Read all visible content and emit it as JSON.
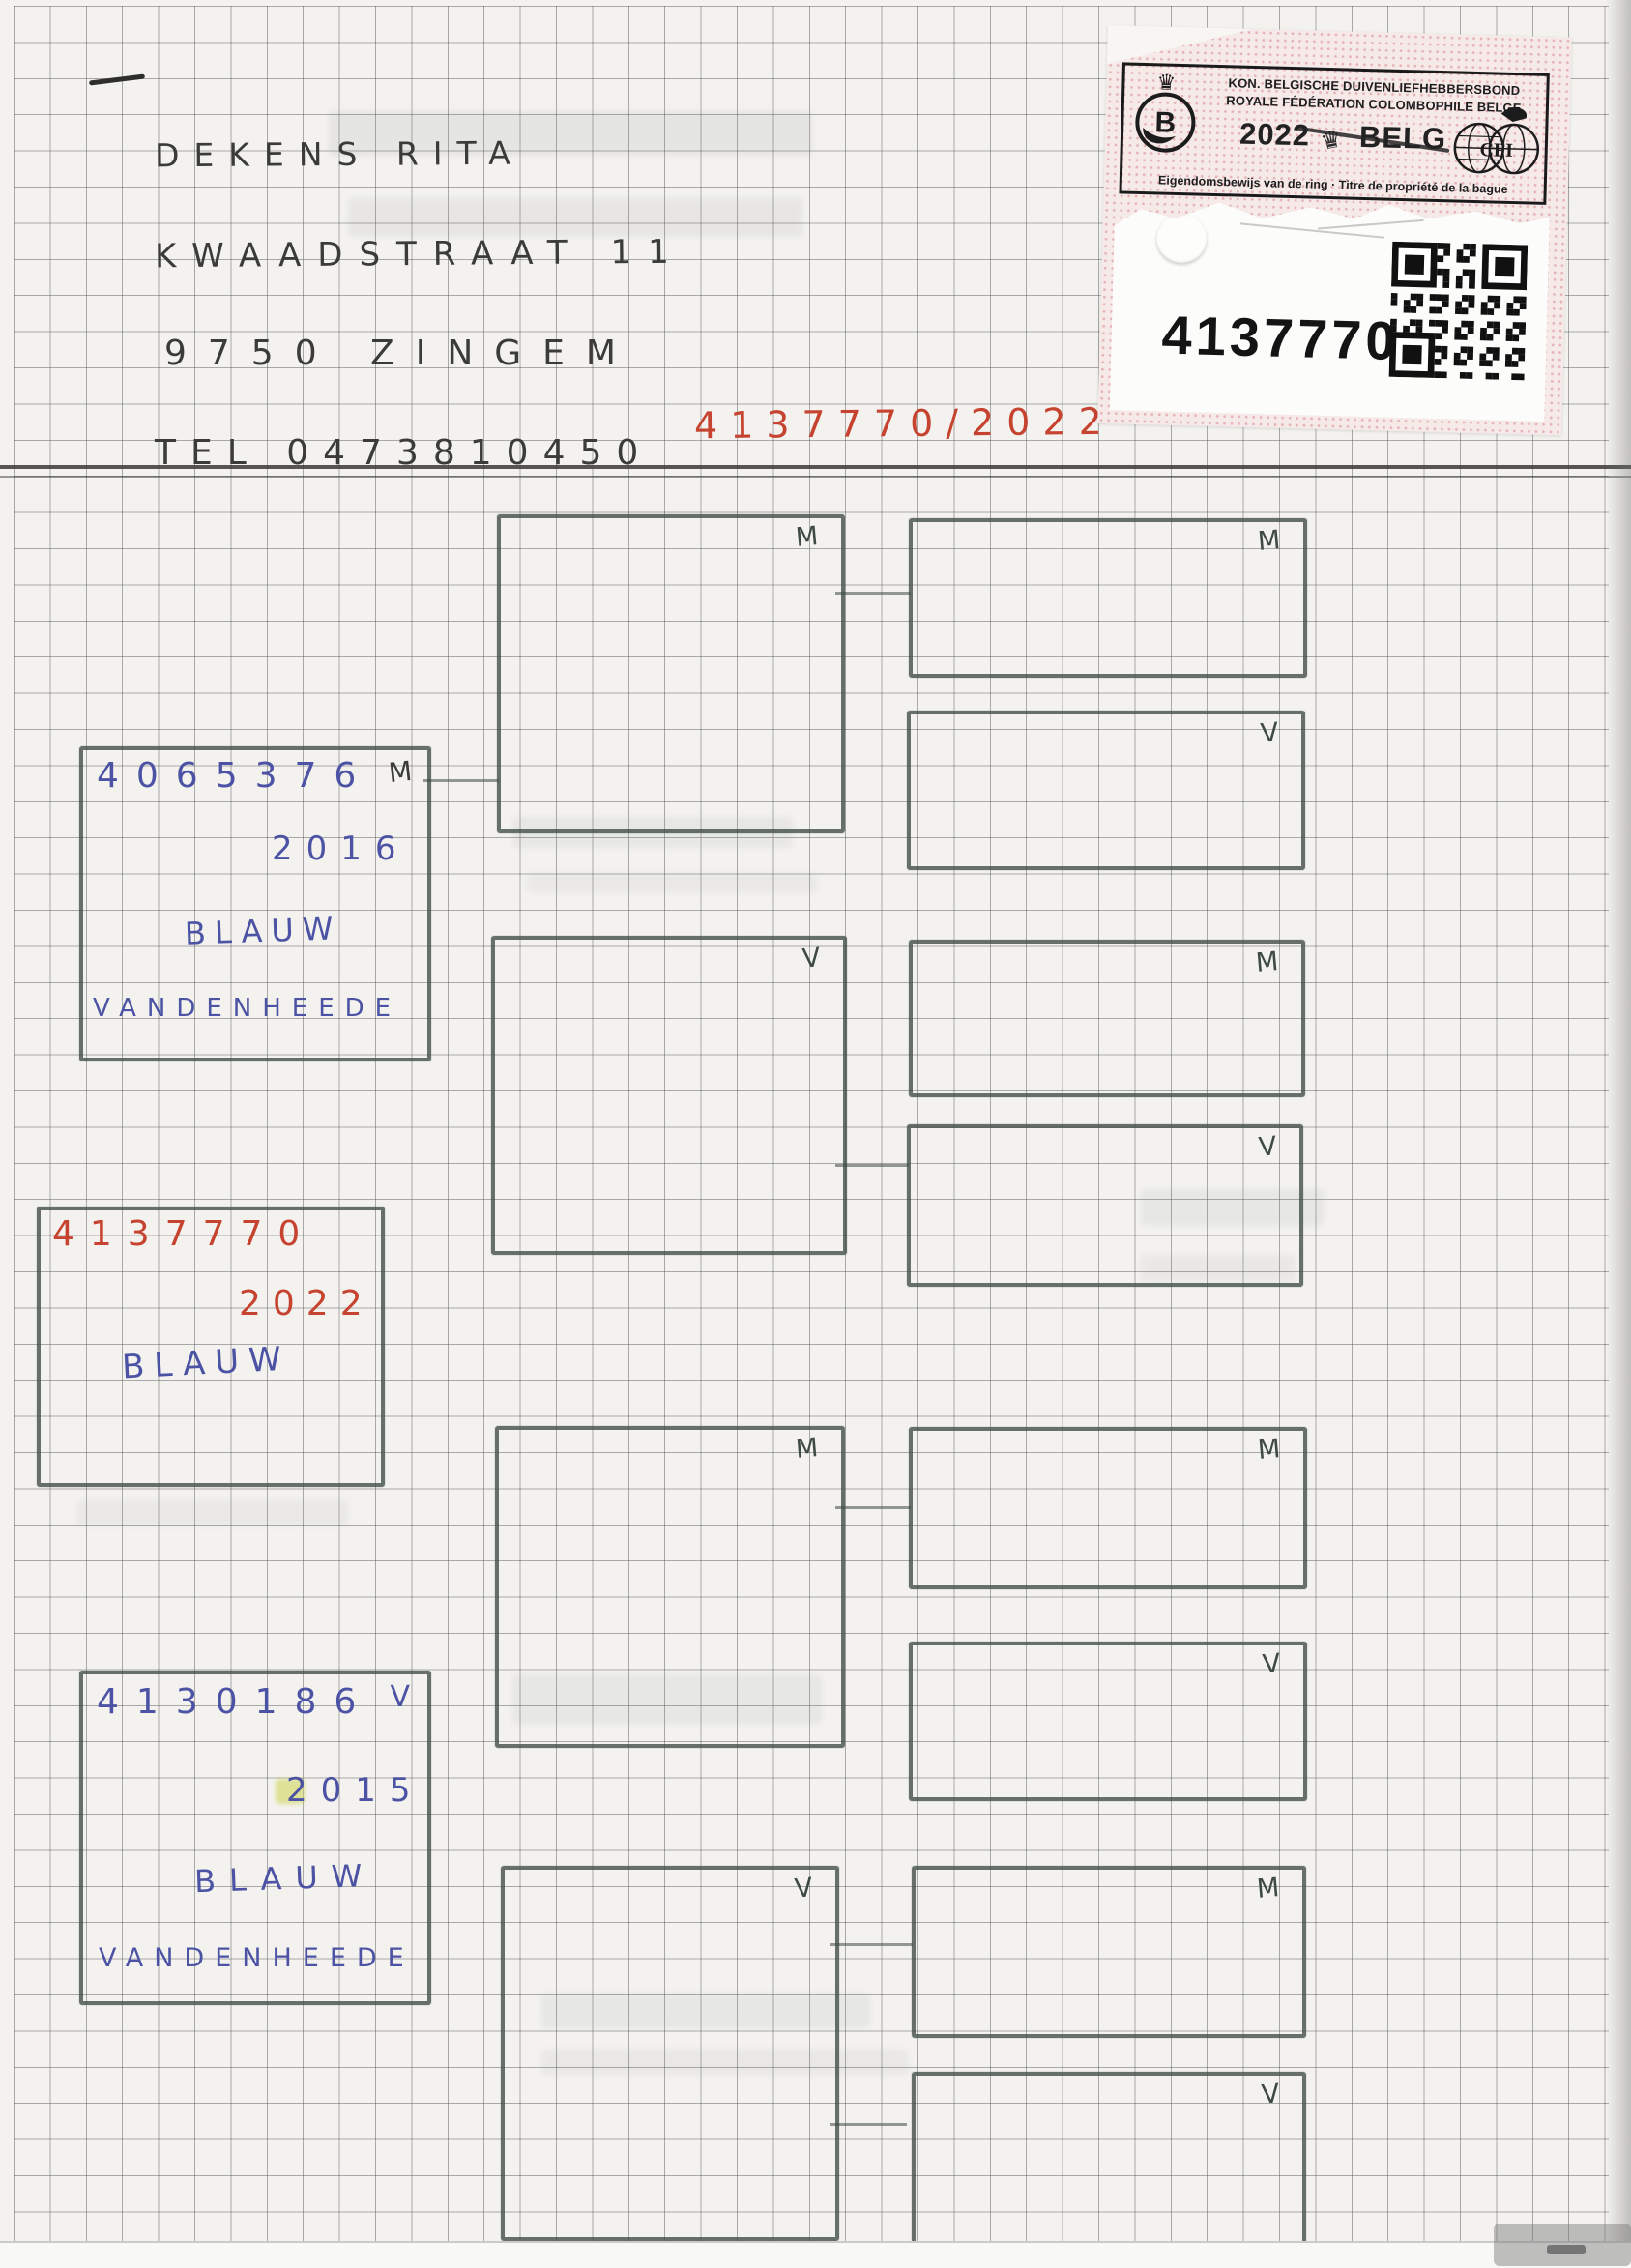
{
  "page": {
    "kind": "Scanned handwritten pigeon pedigree sheet on graph paper"
  },
  "owner": {
    "name": "DEKENS RITA",
    "street": "KWAADSTRAAT 11",
    "city": "9750 ZINGEM",
    "phone": "TEL 0473810450",
    "ring_note": "4137770/2022"
  },
  "sticker": {
    "federation_nl": "KON. BELGISCHE DUIVENLIEFHEBBERSBOND",
    "federation_fr": "ROYALE FÉDÉRATION COLOMBOPHILE BELGE",
    "year": "2022",
    "country": "BELG",
    "title": "Eigendomsbewijs van de ring · Titre de propriété de la bague",
    "ring_number": "4137770",
    "logo_left_letter": "B",
    "logo_right_letters": "CFI",
    "crown_icon": "♛"
  },
  "pedigree": {
    "subject": {
      "ring": "4137770",
      "year": "2022",
      "color": "BLAUW"
    },
    "sire": {
      "ring": "4065376",
      "sex": "M",
      "year": "2016",
      "color": "BLAUW",
      "breeder": "VANDENHEEDE"
    },
    "dam": {
      "ring": "4130186",
      "sex": "V",
      "year": "2015",
      "color": "BLAUW",
      "breeder": "VANDENHEEDE"
    },
    "gen2_labels": [
      "M",
      "V",
      "M",
      "V"
    ],
    "gen3_labels": [
      "M",
      "V",
      "M",
      "V",
      "M",
      "V",
      "M",
      "V"
    ]
  },
  "colors": {
    "red_ink": "#c6432f",
    "blue_ink": "#4d53a4",
    "pencil": "#3b3b39",
    "box_line": "#46584c",
    "sticker_dot_pink": "#e6b3b8"
  }
}
